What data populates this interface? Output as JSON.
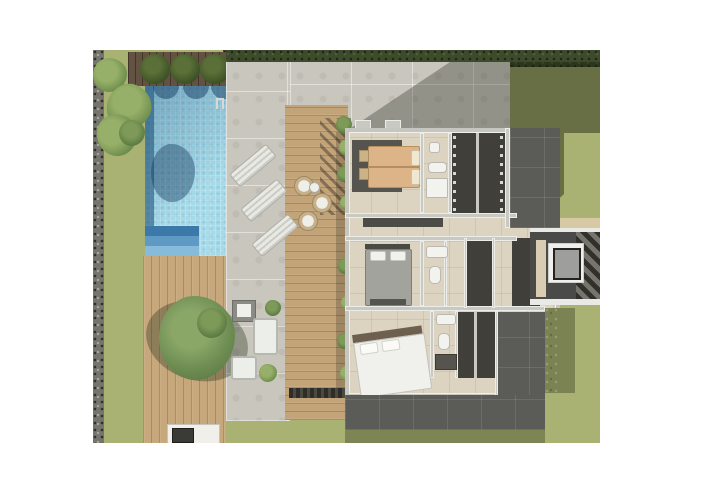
{
  "scene": {
    "type": "3d-floor-plan-render",
    "view": "top-down-aerial",
    "label": "Villa floor plan render with pool and garden",
    "background_color": "#ffffff",
    "visible_text": "none"
  },
  "palette": {
    "pool_water": "#a6dae8",
    "pool_shadow_edge": "#33719f",
    "lawn": "#a9b173",
    "hedge": "#3d4a2b",
    "gravel_border": "#75756d",
    "concrete_paving": "#c9c6bd",
    "timber_deck": "#c6a87c",
    "dark_timber_band": "#635142",
    "interior_floor": "#dcd4c1",
    "dark_rooms": "#403f3a",
    "dark_terrace_tile": "#5b5b58",
    "walls": "#c9c9c4",
    "bed1_duvet": "#dcb488",
    "bed2_duvet": "#a3a39d",
    "bed3_duvet": "#f0f0ec",
    "fixtures": "#f2f2ef",
    "elevator_cab": "#9e9e9c"
  },
  "garden": {
    "label": "Garden",
    "pool": {
      "label": "Swimming pool",
      "shape": "rectangular",
      "corner_steps": 3,
      "ladder": 1,
      "topiary_shadows_on_water": 3
    },
    "lawn": {
      "label": "Lawn"
    },
    "hedge_top": {
      "label": "Boundary hedge"
    },
    "gravel_border": {
      "label": "Gravel border strip"
    },
    "palm_cluster": {
      "label": "Palm cluster",
      "palms": 3
    },
    "topiary_bushes": {
      "label": "Topiary bushes",
      "count": 3
    },
    "dark_timber_band": {
      "label": "Dark timber strip behind pool"
    }
  },
  "terraces": {
    "pool_deck": {
      "label": "Concrete pool deck",
      "sun_loungers": 3
    },
    "upper_timber_deck": {
      "label": "Timber deck beside house",
      "wicker_chairs": 3,
      "side_table": 1,
      "planters": 8,
      "pergola_shade": true
    },
    "lower_timber_deck": {
      "label": "Lower timber deck",
      "tree": 1,
      "bbq_counter": 1
    },
    "lounge_set": {
      "label": "Outdoor lounge set",
      "sofas": 2,
      "armchairs": 1,
      "coffee_table": 1
    },
    "south_patio": {
      "label": "South dark-tiled patio"
    },
    "ne_terrace": {
      "label": "North-east dark terrace"
    },
    "se_terrace": {
      "label": "South-east dark terrace"
    }
  },
  "house": {
    "label": "Villa - single storey",
    "bedrooms": [
      {
        "label": "Bedroom 1 (master)",
        "bed_color": "tan",
        "pillows": 2,
        "rug": "charcoal"
      },
      {
        "label": "Bedroom 2",
        "bed_color": "grey",
        "pillows": 2,
        "foot_bench": 1
      },
      {
        "label": "Bedroom 3",
        "bed_color": "white",
        "pillows": 2
      }
    ],
    "bathrooms": [
      {
        "label": "Bathroom 1",
        "fixtures": [
          "sink",
          "toilet",
          "shower"
        ]
      },
      {
        "label": "Bathroom 2",
        "fixtures": [
          "sink",
          "toilet"
        ]
      },
      {
        "label": "Bathroom 3",
        "fixtures": [
          "sink",
          "toilet",
          "shower"
        ]
      }
    ],
    "storage": [
      {
        "label": "Walk-in closet 1"
      },
      {
        "label": "Walk-in closet 2"
      },
      {
        "label": "Wardrobe room"
      }
    ],
    "circulation": {
      "hallway": {
        "label": "Hallway",
        "console": 1
      },
      "corridor": {
        "label": "Corridor"
      },
      "stair_tower": {
        "label": "Stair tower",
        "elevator": 1,
        "stair_flights": 1
      }
    }
  }
}
